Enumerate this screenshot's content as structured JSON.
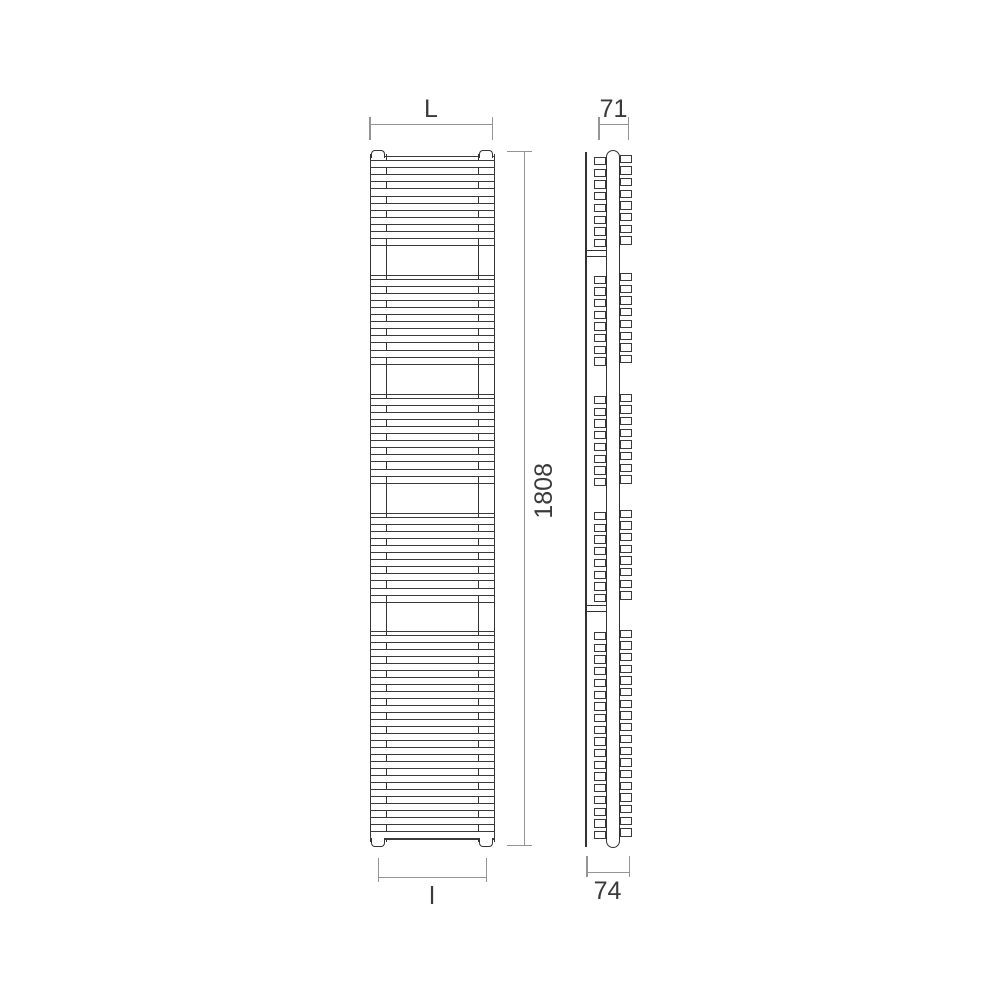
{
  "drawing": {
    "type": "technical-dimension-drawing",
    "subject": "vertical towel radiator, front and side views",
    "dimensions": {
      "overall_width_label": "L",
      "depth_top_label": "71",
      "overall_height_label": "1808",
      "connection_width_label": "l",
      "depth_bottom_label": "74"
    },
    "colors": {
      "background": "#ffffff",
      "object_line": "#333333",
      "dimension_line": "#949494",
      "label_text": "#3a3a3a"
    },
    "front_view": {
      "bar_height": 8.2,
      "groups": [
        {
          "edge_top": 8,
          "bars_top": 12,
          "count": 6,
          "pitch": 14.2,
          "edge_bottom": 96.5
        },
        {
          "edge_top": 126.5,
          "bars_top": 130.5,
          "count": 6,
          "pitch": 14.2,
          "edge_bottom": 215.5
        },
        {
          "edge_top": 245.5,
          "bars_top": 249.5,
          "count": 6,
          "pitch": 14.2,
          "edge_bottom": 334.5
        },
        {
          "edge_top": 364.5,
          "bars_top": 368.5,
          "count": 6,
          "pitch": 14.2,
          "edge_bottom": 453.5
        },
        {
          "edge_top": 482.5,
          "bars_top": 486.5,
          "count": 15,
          "pitch": 14.0,
          "edge_bottom": 690.5
        }
      ]
    },
    "side_view": {
      "square_pitch": 11.7,
      "back_column_offset": -2.5,
      "bracket_tops": [
        102,
        457
      ],
      "groups": [
        {
          "top": 9,
          "count": 8
        },
        {
          "top": 127.5,
          "count": 8
        },
        {
          "top": 248,
          "count": 8
        },
        {
          "top": 364,
          "count": 8
        },
        {
          "top": 484,
          "count": 18
        }
      ]
    }
  }
}
